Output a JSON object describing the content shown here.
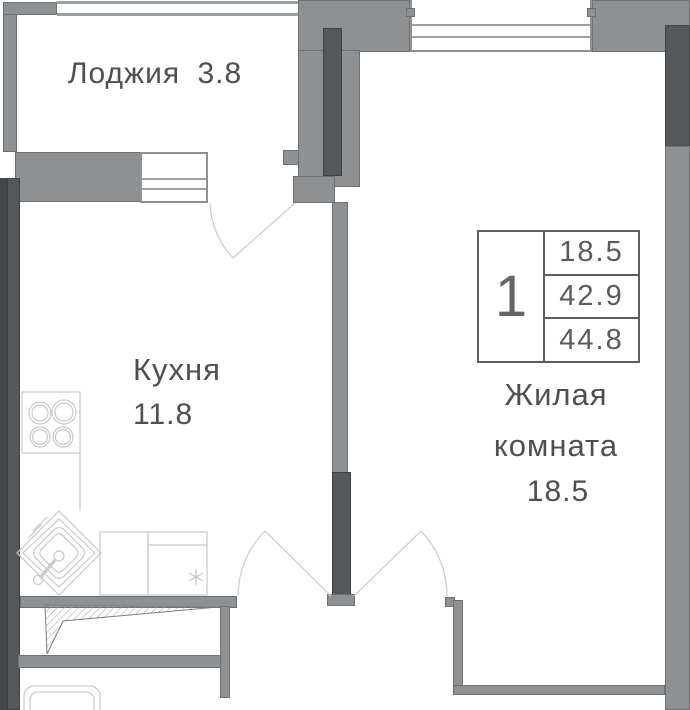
{
  "plan": {
    "type": "apartment-floor-plan",
    "rooms": {
      "loggia": {
        "label": "Лоджия",
        "area": "3.8"
      },
      "kitchen": {
        "label": "Кухня",
        "area": "11.8"
      },
      "living": {
        "label_line1": "Жилая",
        "label_line2": "комната",
        "area": "18.5"
      }
    },
    "info_table": {
      "rooms_count": "1",
      "rows": [
        "18.5",
        "42.9",
        "44.8"
      ]
    },
    "colors": {
      "wall_medium": "#8e9193",
      "wall_dark": "#54585b",
      "wall_darker": "#44484b",
      "window_line": "#8f9193",
      "fixture_line": "#c6c8c9",
      "door_arc": "#cdcfd0",
      "text": "#4d4f50"
    },
    "icons": {
      "stove": "stove-icon",
      "sink": "sink-icon",
      "counters": "counter-icon",
      "bathtub": "bathtub-icon",
      "marker": "asterisk-marker",
      "shaft": "hatched-shaft"
    }
  }
}
